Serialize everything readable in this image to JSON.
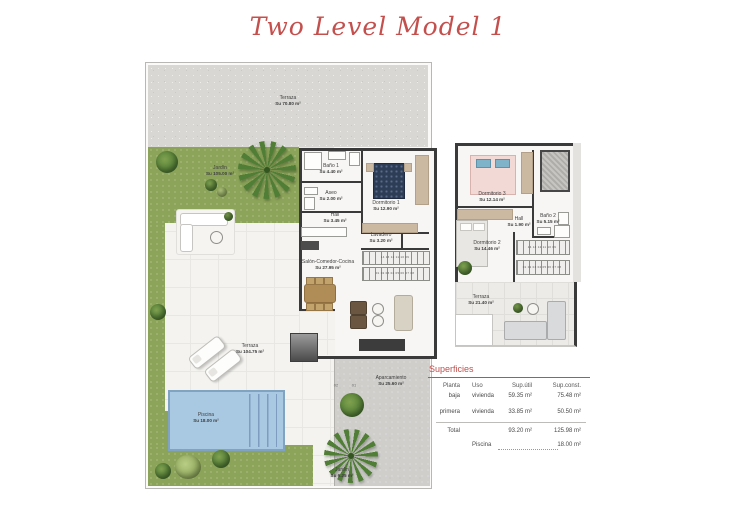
{
  "title": "Two Level Model 1",
  "plans": {
    "ground": {
      "terraza_sup": {
        "name": "Terraza",
        "area": "Su 70.80 m²"
      },
      "jardin": {
        "name": "Jardín",
        "area": "Su 105.00 m²"
      },
      "bano1": {
        "name": "Baño 1",
        "area": "Su 4.40 m²"
      },
      "dormitorio1": {
        "name": "Dormitorio 1",
        "area": "Su 12.90 m²"
      },
      "aseo": {
        "name": "Aseo",
        "area": "Su 2.00 m²"
      },
      "hall": {
        "name": "Hall",
        "area": "Su 3.45 m²"
      },
      "lavadero": {
        "name": "Lavadero",
        "area": "Su 3.20 m²"
      },
      "salon": {
        "name": "Salón-Comedor-Cocina",
        "area": "Su 27.95 m²"
      },
      "terraza_patio": {
        "name": "Terraza",
        "area": "Su 104.75 m²"
      },
      "piscina": {
        "name": "Piscina",
        "area": "Su 18.00 m²"
      },
      "aparcamiento": {
        "name": "Aparcamiento",
        "area": "Su 25.60 m²"
      },
      "jardin_small": {
        "name": "Jardín",
        "area": "Su 6.25 m²"
      },
      "parking_spot_left": "02",
      "parking_spot_right": "01",
      "stairs_row1": "14 13 12 11 10 09",
      "stairs_row2": "01 02 03 04 05 06 07 08"
    },
    "upper": {
      "dormitorio3": {
        "name": "Dormitorio 3",
        "area": "Su 12.14 m²"
      },
      "hall": {
        "name": "Hall",
        "area": "Su 1.90 m²"
      },
      "bano2": {
        "name": "Baño 2",
        "area": "Su 5.15 m²"
      },
      "dormitorio2": {
        "name": "Dormitorio 2",
        "area": "Su 14.46 m²"
      },
      "terraza": {
        "name": "Terraza",
        "area": "Su 21.40 m²"
      },
      "stairs_row1": "14 13 12 11 10 09",
      "stairs_row2": "01 02 03 04 05 06 07 08"
    }
  },
  "summary": {
    "title": "Superficies",
    "col_planta": "Planta",
    "col_uso": "Uso",
    "col_sup_util": "Sup.útil",
    "col_sup_const": "Sup.const.",
    "rows": [
      {
        "planta": "baja",
        "uso": "vivienda",
        "sup_util": "59.35 m²",
        "sup_const": "75.48 m²"
      },
      {
        "planta": "primera",
        "uso": "vivienda",
        "sup_util": "33.85 m²",
        "sup_const": "50.50 m²"
      }
    ],
    "total_label": "Total",
    "total_sup_util": "93.20 m²",
    "total_sup_const": "125.98 m²",
    "piscina_label": "Piscina",
    "piscina_value": "18.00 m²"
  },
  "colors": {
    "accent_red": "#c0504d",
    "title_red": "#c4504e",
    "grass_green": "#8ca459",
    "pool_blue": "#a9c9e3",
    "wall_dark": "#3a3a3a"
  }
}
